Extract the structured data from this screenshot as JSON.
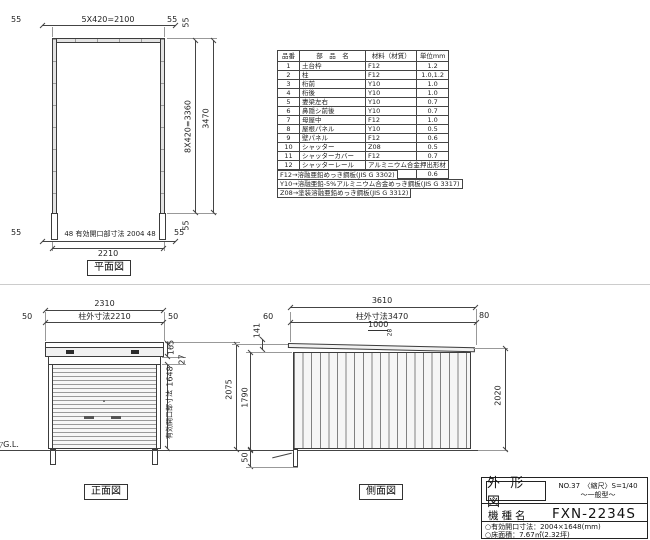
{
  "plan": {
    "title": "平面図",
    "top": {
      "left": "55",
      "center": "5X420=2100",
      "right": "55"
    },
    "right": {
      "top": "55",
      "mid": "8X420=3360",
      "total": "3470",
      "bottom": "55"
    },
    "bottom": {
      "left": "55",
      "opening": "48 有効開口部寸法 2004 48",
      "right": "55",
      "total": "2210"
    }
  },
  "parts_table": {
    "headers": [
      "品番",
      "部　品　名",
      "材料（材質）",
      "単位mm"
    ],
    "rows": [
      [
        "1",
        "土台枠",
        "F12",
        "1.2"
      ],
      [
        "2",
        "柱",
        "F12",
        "1.0,1.2"
      ],
      [
        "3",
        "桁前",
        "Y10",
        "1.0"
      ],
      [
        "4",
        "桁後",
        "Y10",
        "1.0"
      ],
      [
        "5",
        "妻梁左右",
        "Y10",
        "0.7"
      ],
      [
        "6",
        "鼻隠シ前後",
        "Y10",
        "0.7"
      ],
      [
        "7",
        "母屋中",
        "F12",
        "1.0"
      ],
      [
        "8",
        "屋根パネル",
        "Y10",
        "0.5"
      ],
      [
        "9",
        "壁パネル",
        "F12",
        "0.6"
      ],
      [
        "10",
        "シャッター",
        "Z08",
        "0.5"
      ],
      [
        "11",
        "シャッターカバー",
        "F12",
        "0.7"
      ],
      [
        "12",
        "シャッターレール",
        "アルミニウム合金押出形材",
        ""
      ],
      [
        "13",
        "棚板（別売）",
        "F12",
        "0.6"
      ]
    ],
    "notes": [
      "F12→溶融亜鉛めっき鋼板(JIS G 3302)",
      "Y10→溶融亜鉛-5%アルミニウム合金めっき鋼板(JIS G 3317)",
      "Z08→塗装溶融亜鉛めっき鋼板(JIS G 3312)"
    ]
  },
  "front": {
    "title": "正面図",
    "width_total": "2310",
    "width_left": "50",
    "width_center": "柱外寸法2210",
    "width_right": "50",
    "h_roof": "165",
    "h_gap": "27",
    "h_opening": "1648",
    "opening_label": "有効開口部寸法",
    "gl": "▽G.L."
  },
  "side": {
    "title": "側面図",
    "w_total": "3610",
    "w_left": "60",
    "w_center": "柱外寸法3470",
    "w_right": "80",
    "h_eave": "141",
    "slope_run": "1000",
    "slope_rise": "28",
    "h_total": "2075",
    "h_wall": "1790",
    "h_below": "50",
    "h_back": "2020"
  },
  "title_block": {
    "drawing_type": "外 形 図",
    "no_scale": "NO.37　〈縮尺〉S=1/40",
    "type_note": "〜一般型〜",
    "model_label": "機種名",
    "model": "FXN-2234S",
    "spec1": "○有効開口寸法：2004×1648(mm)",
    "spec2": "○床面積：7.67㎡(2.32坪)"
  },
  "colors": {
    "line": "#444444",
    "wall_fill": "#e3e3e3",
    "divider": "#cccccc"
  }
}
